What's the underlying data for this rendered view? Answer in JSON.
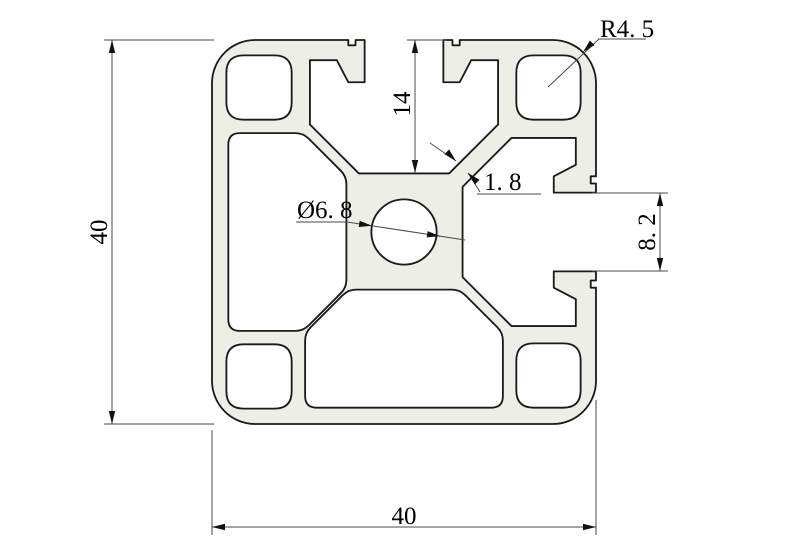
{
  "drawing": {
    "labels": {
      "height": "40",
      "width": "40",
      "slot_depth": "14",
      "slot_opening": "8. 2",
      "wall_thickness": "1. 8",
      "center_hole_dia": "Ø6. 8",
      "corner_radius": "R4. 5"
    },
    "colors": {
      "body": "#edeee8",
      "cavity": "#ffffff",
      "outline": "#1a1a1a",
      "dimension": "#4a4a4a"
    }
  }
}
